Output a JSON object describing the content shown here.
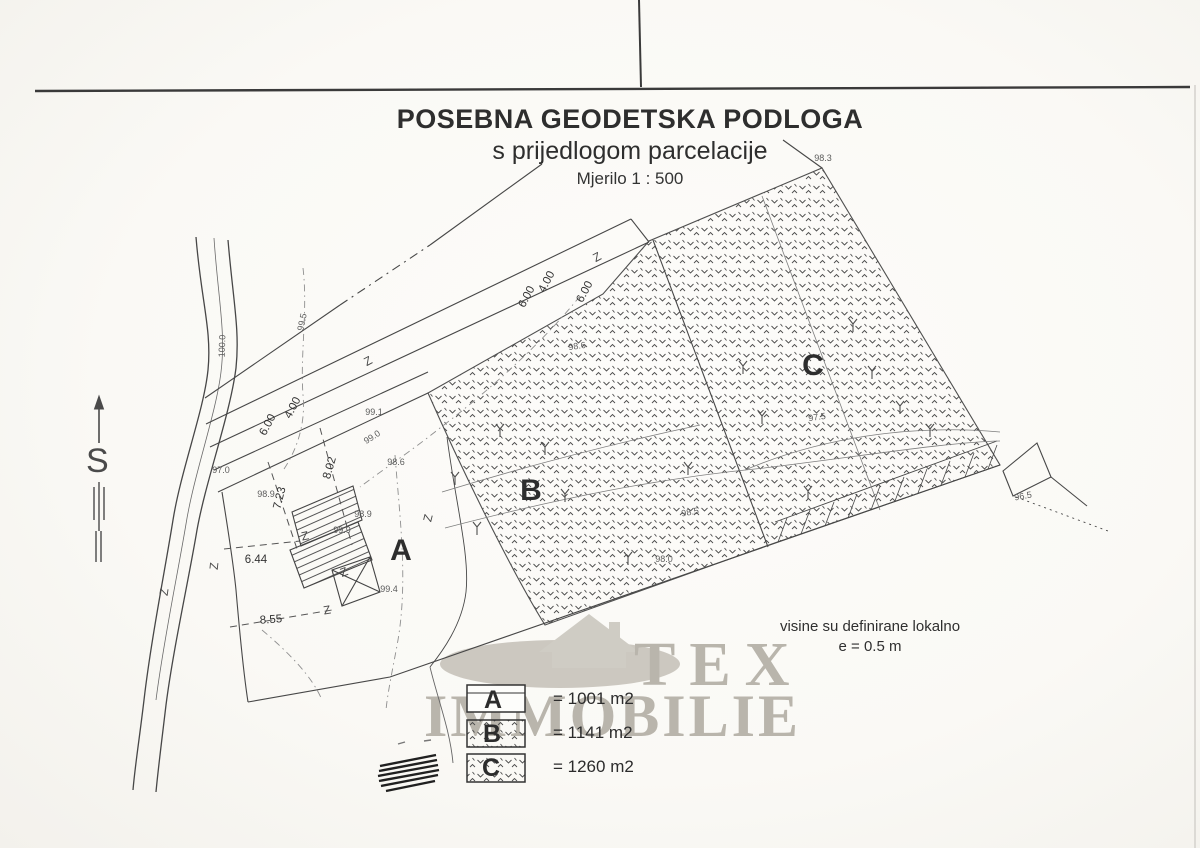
{
  "title": {
    "line1": "POSEBNA GEODETSKA PODLOGA",
    "line2": "s prijedlogom parcelacije",
    "scale": "Mjerilo 1 : 500"
  },
  "note": {
    "line1": "visine su definirane lokalno",
    "line2": "e = 0.5 m"
  },
  "north": {
    "label": "S"
  },
  "watermark": {
    "line1": "TEX",
    "line2": "IMMOBILIE",
    "color": "#b9b5ac"
  },
  "legend": {
    "items": [
      {
        "letter": "A",
        "area": "= 1001 m2",
        "fill": "blank"
      },
      {
        "letter": "B",
        "area": "= 1141 m2",
        "fill": "hatch"
      },
      {
        "letter": "C",
        "area": "= 1260 m2",
        "fill": "hatch"
      }
    ]
  },
  "map": {
    "ink": "#474747",
    "fence_glyph": "Z",
    "parcel_labels": [
      {
        "text": "A",
        "x": 401,
        "y": 551,
        "rot": 0
      },
      {
        "text": "B",
        "x": 531,
        "y": 491,
        "rot": 0
      },
      {
        "text": "C",
        "x": 813,
        "y": 366,
        "rot": 0
      }
    ],
    "dimensions": [
      {
        "text": "4.00",
        "x": 293,
        "y": 408,
        "rot": -62
      },
      {
        "text": "6.00",
        "x": 268,
        "y": 425,
        "rot": -62
      },
      {
        "text": "4.00",
        "x": 547,
        "y": 282,
        "rot": -62
      },
      {
        "text": "6.00",
        "x": 527,
        "y": 297,
        "rot": -62
      },
      {
        "text": "6.00",
        "x": 585,
        "y": 292,
        "rot": -62
      },
      {
        "text": "8.02",
        "x": 330,
        "y": 468,
        "rot": -74
      },
      {
        "text": "7.23",
        "x": 280,
        "y": 498,
        "rot": -76
      },
      {
        "text": "6.44",
        "x": 256,
        "y": 560,
        "rot": 0
      },
      {
        "text": "8.55",
        "x": 271,
        "y": 620,
        "rot": -4
      }
    ],
    "elevations": [
      {
        "text": "100.0",
        "x": 222,
        "y": 346,
        "rot": -88
      },
      {
        "text": "99.5",
        "x": 302,
        "y": 322,
        "rot": -78
      },
      {
        "text": "99.0",
        "x": 372,
        "y": 437,
        "rot": -33
      },
      {
        "text": "99.1",
        "x": 374,
        "y": 412,
        "rot": 0
      },
      {
        "text": "98.6",
        "x": 396,
        "y": 462,
        "rot": 0
      },
      {
        "text": "98.6",
        "x": 577,
        "y": 346,
        "rot": -8
      },
      {
        "text": "98.3",
        "x": 823,
        "y": 158,
        "rot": 0
      },
      {
        "text": "98.9",
        "x": 266,
        "y": 494,
        "rot": 0
      },
      {
        "text": "98.9",
        "x": 363,
        "y": 514,
        "rot": 0
      },
      {
        "text": "99.9",
        "x": 342,
        "y": 530,
        "rot": 0
      },
      {
        "text": "99.4",
        "x": 389,
        "y": 589,
        "rot": 0
      },
      {
        "text": "98.5",
        "x": 690,
        "y": 512,
        "rot": -10
      },
      {
        "text": "98.0",
        "x": 664,
        "y": 559,
        "rot": 0
      },
      {
        "text": "97.5",
        "x": 817,
        "y": 417,
        "rot": -8
      },
      {
        "text": "96.5",
        "x": 1023,
        "y": 496,
        "rot": -10
      },
      {
        "text": "97.0",
        "x": 221,
        "y": 470,
        "rot": 0
      }
    ],
    "fence_marks": [
      {
        "x": 368,
        "y": 361,
        "rot": -28
      },
      {
        "x": 597,
        "y": 257,
        "rot": -28
      },
      {
        "x": 305,
        "y": 536,
        "rot": -12
      },
      {
        "x": 214,
        "y": 566,
        "rot": -84
      },
      {
        "x": 327,
        "y": 610,
        "rot": -10
      },
      {
        "x": 344,
        "y": 572,
        "rot": -20
      },
      {
        "x": 428,
        "y": 518,
        "rot": -76
      },
      {
        "x": 164,
        "y": 592,
        "rot": -82
      }
    ],
    "trees": [
      [
        455,
        478
      ],
      [
        477,
        528
      ],
      [
        545,
        448
      ],
      [
        565,
        495
      ],
      [
        743,
        367
      ],
      [
        853,
        325
      ],
      [
        872,
        372
      ],
      [
        762,
        417
      ],
      [
        900,
        407
      ],
      [
        628,
        558
      ],
      [
        688,
        468
      ],
      [
        808,
        492
      ],
      [
        930,
        430
      ],
      [
        500,
        430
      ]
    ]
  }
}
